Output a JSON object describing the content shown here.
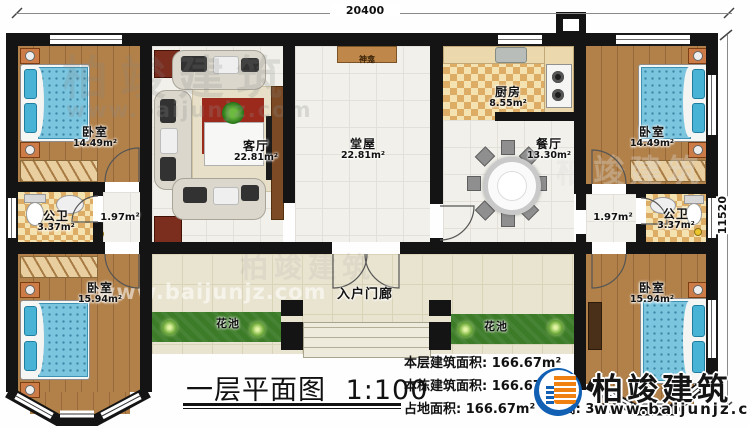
{
  "plan": {
    "dim_top": "20400",
    "dim_right": "11520",
    "rooms": {
      "bedroom_tl": {
        "name": "卧室",
        "area": "14.49m²"
      },
      "bedroom_tr": {
        "name": "卧室",
        "area": "14.49m²"
      },
      "bedroom_bl": {
        "name": "卧室",
        "area": "15.94m²"
      },
      "bedroom_br": {
        "name": "卧室",
        "area": "15.94m²"
      },
      "living_room": {
        "name": "客厅",
        "area": "22.81m²"
      },
      "hall": {
        "name": "堂屋",
        "area": "22.81m²"
      },
      "kitchen": {
        "name": "厨房",
        "area": "8.55m²"
      },
      "dining_room": {
        "name": "餐厅",
        "area": "13.30m²"
      },
      "bathroom_left": {
        "name": "公卫",
        "area": "3.37m²"
      },
      "bathroom_right": {
        "name": "公卫",
        "area": "3.37m²"
      },
      "corridor_left": {
        "area": "1.97m²"
      },
      "corridor_right": {
        "area": "1.97m²"
      },
      "porch": {
        "name": "入户门廊"
      },
      "flower_bed": {
        "name": "花池"
      },
      "shrine": {
        "name": "神龛"
      }
    }
  },
  "titleblock": {
    "title": "一层平面图",
    "scale": "1:100",
    "stats": [
      {
        "label": "本层建筑面积:",
        "value": "166.67m²"
      },
      {
        "label": "本栋建筑面积:",
        "value": "166.67m²"
      },
      {
        "label": "占地面积:",
        "value": "166.67m²",
        "label2": "层高:",
        "value2": "3.6m"
      }
    ]
  },
  "branding": {
    "name": "柏竣建筑",
    "website": "www.baijunjz.com"
  }
}
